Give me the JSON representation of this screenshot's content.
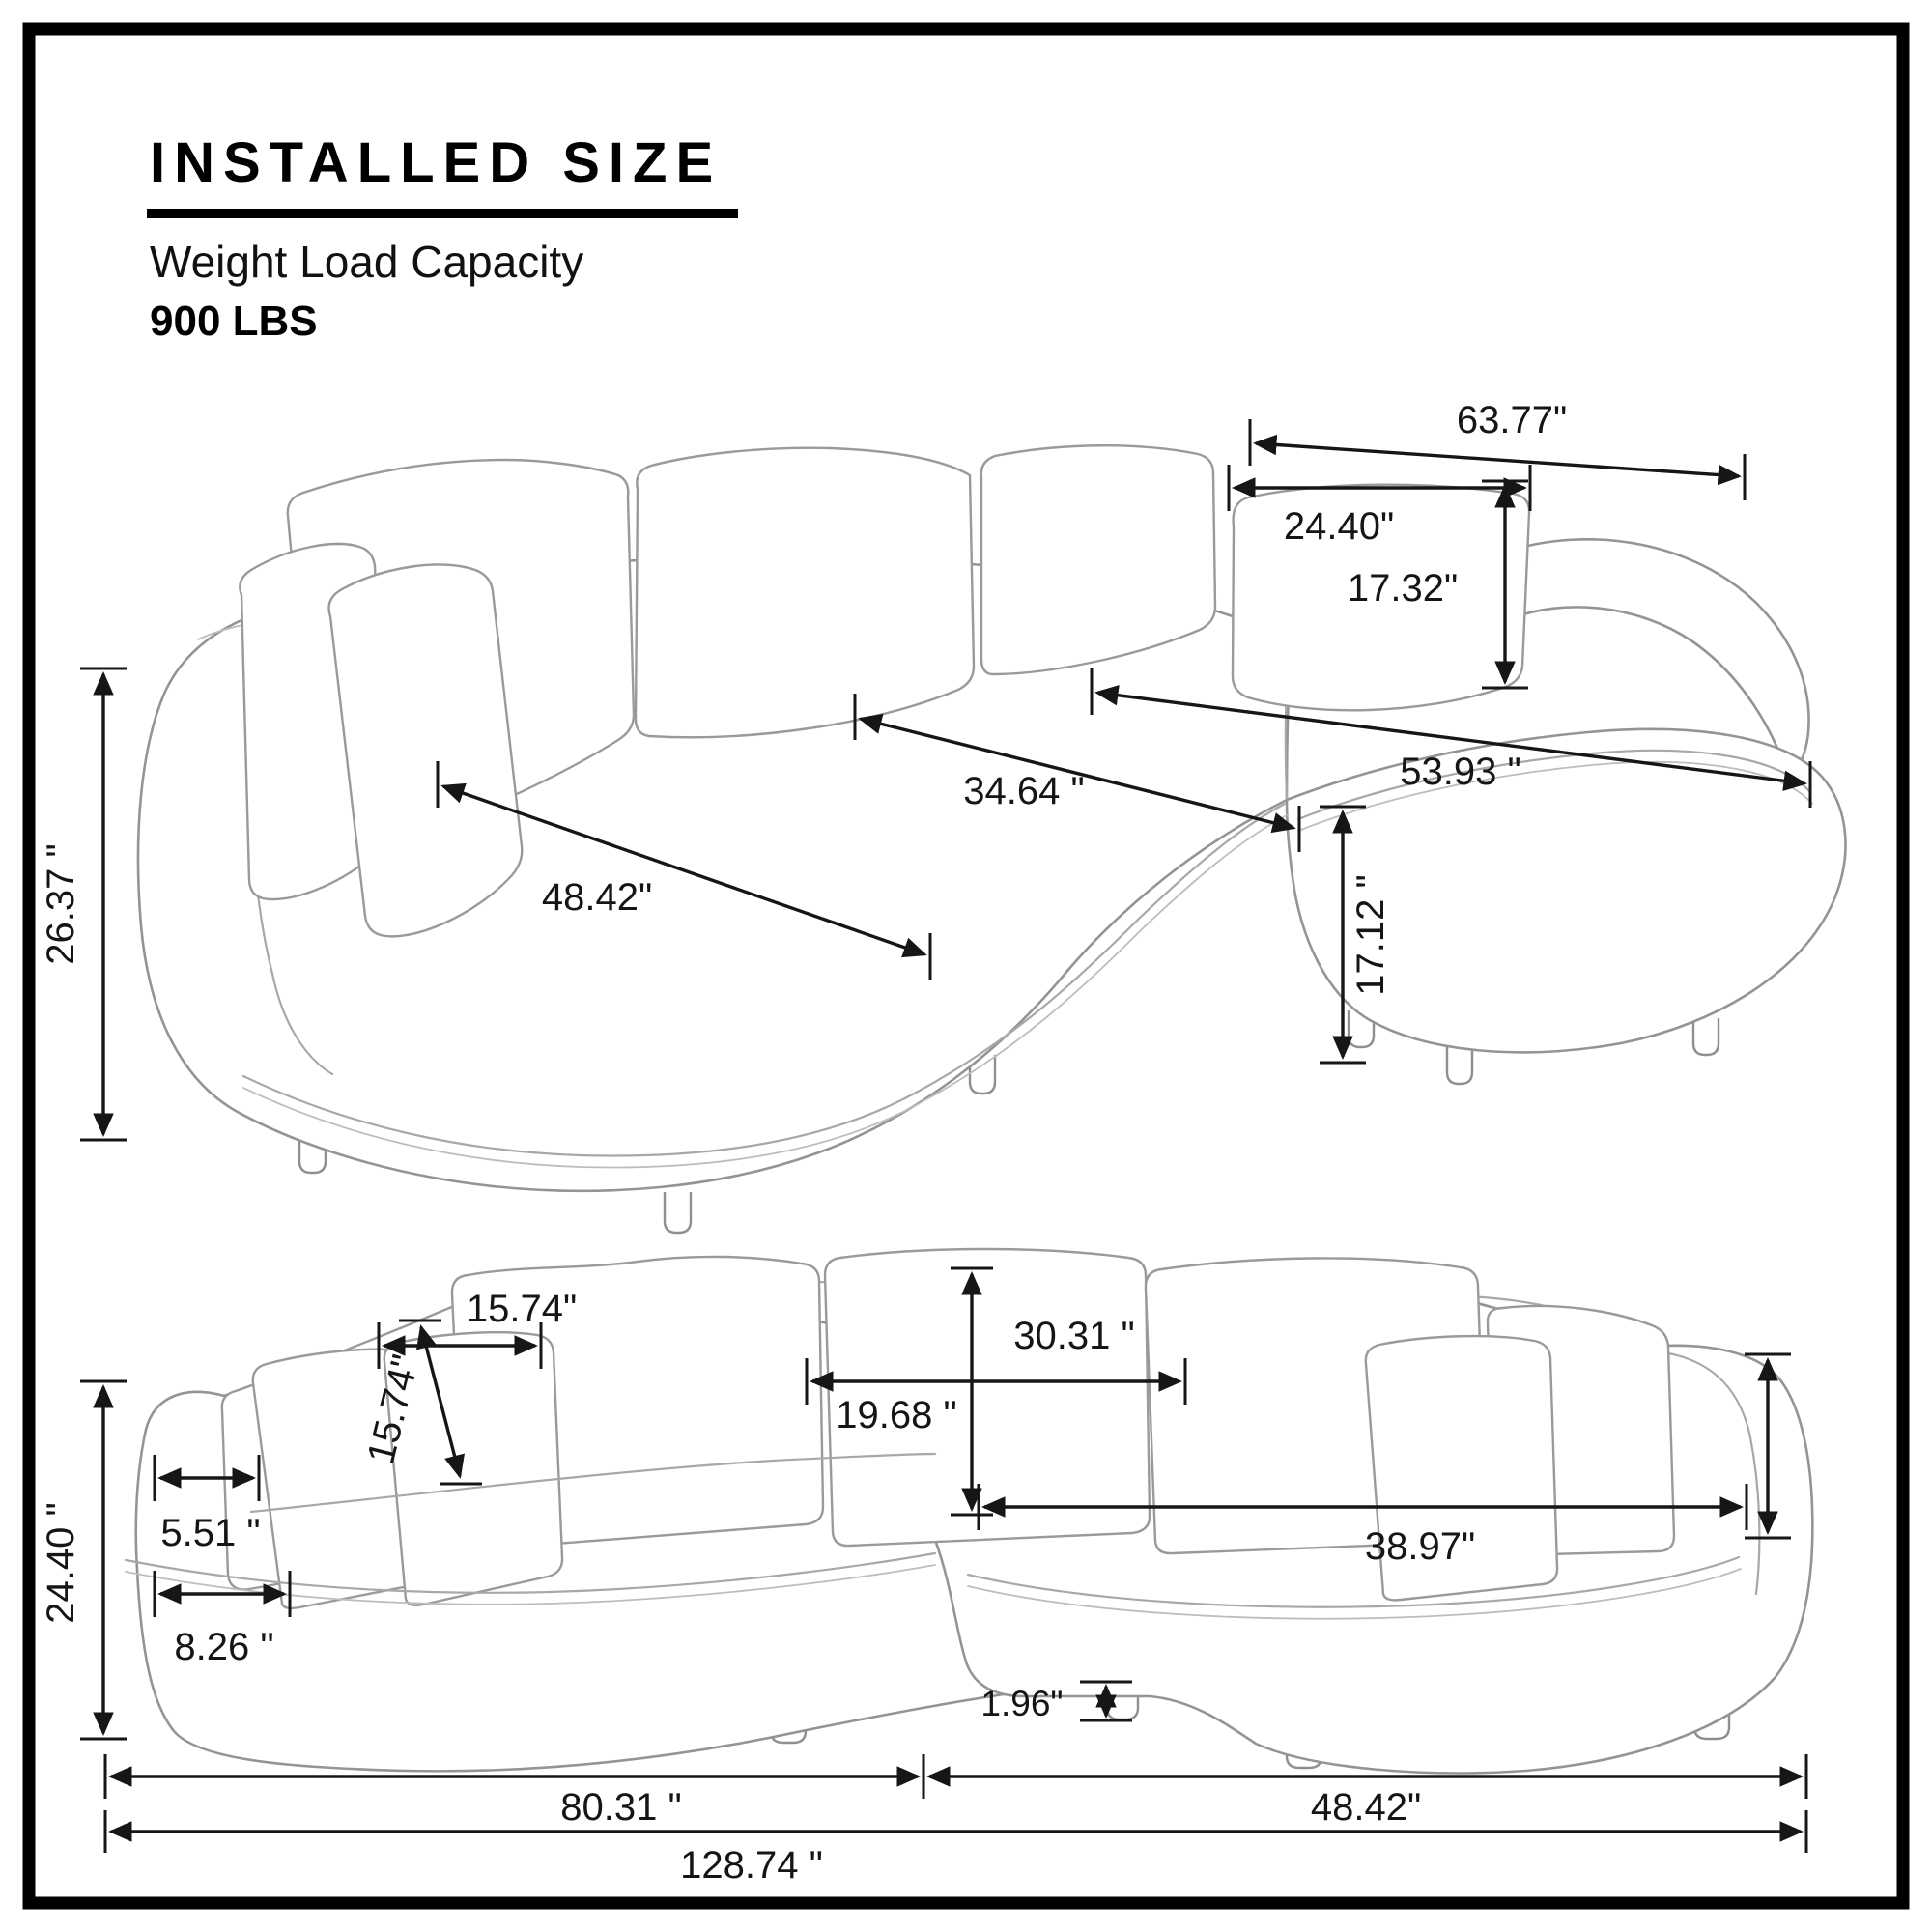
{
  "header": {
    "title": "INSTALLED SIZE",
    "subtitle": "Weight Load Capacity",
    "capacity": "900 LBS"
  },
  "top_view": {
    "name": "sectional sofa - top perspective view",
    "dims": {
      "back_width": "63.77\"",
      "back_cushion_width": "24.40\"",
      "back_cushion_height": "17.32\"",
      "seat_depth_diagonal": "34.64 \"",
      "chaise_length": "53.93 \"",
      "seat_width_diagonal": "48.42\"",
      "overall_height": "26.37 \"",
      "seat_height": "17.12 \""
    }
  },
  "front_view": {
    "name": "sectional sofa - front elevation view",
    "dims": {
      "overall_height": "24.40 \"",
      "arm_top_depth": "5.51 \"",
      "arm_base_depth": "8.26 \"",
      "toss_pillow_width": "15.74\"",
      "toss_pillow_height": "15.74\"",
      "back_cushion_width": "30.31 \"",
      "back_cushion_height": "19.68 \"",
      "chaise_seat_width": "38.97\"",
      "leg_height": "1.96\"",
      "left_section_width": "80.31 \"",
      "right_section_width": "48.42\"",
      "overall_width": "128.74 \""
    }
  }
}
